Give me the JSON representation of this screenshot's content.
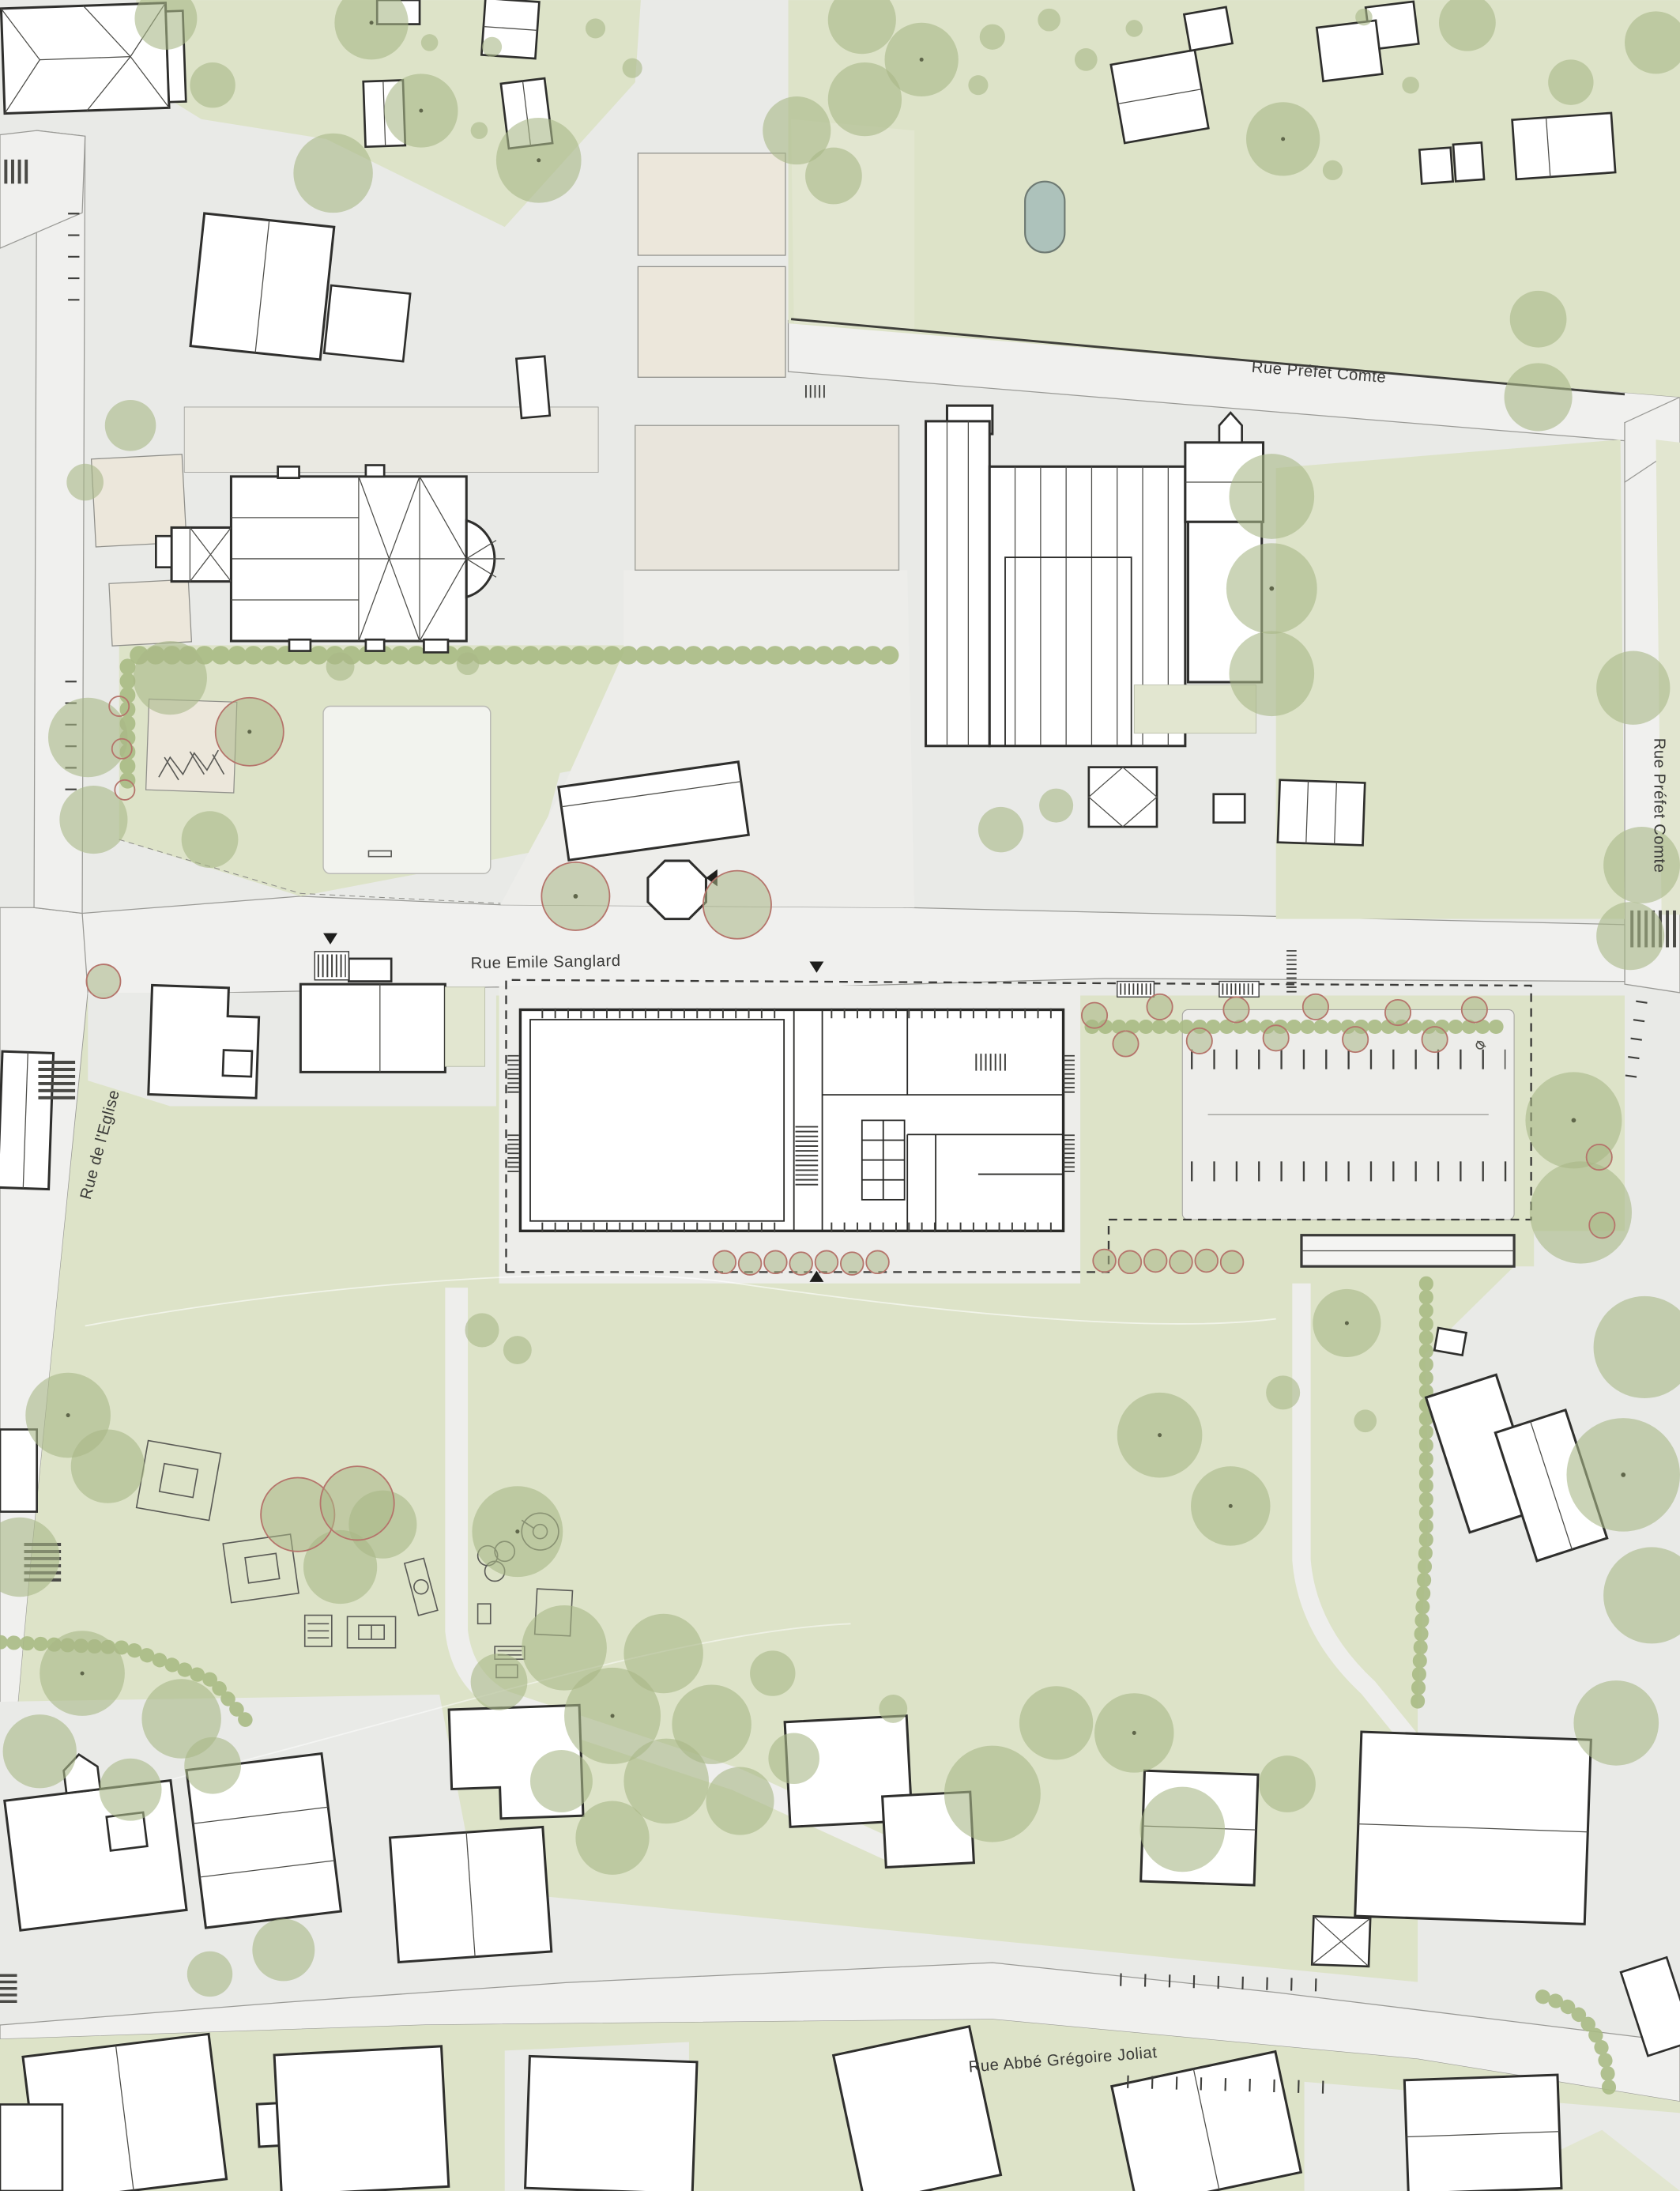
{
  "title": "Architectural site plan",
  "streets": {
    "prefet_comte_top": "Rue Préfet Comte",
    "prefet_comte_right": "Rue Préfet Comte",
    "emile_sanglard": "Rue Emile Sanglard",
    "eglise": "Rue de l'Eglise",
    "abbe_gregoire_joliat": "Rue Abbé Grégoire Joliat"
  },
  "colors": {
    "background": "#e9eae7",
    "road": "#f0f0ee",
    "green_space": "#dde3c8",
    "tree_canopy": "#a9b787",
    "new_tree_ring": "#b5746b",
    "building_fill": "#ffffff",
    "building_stroke": "#2f2f2d",
    "gravel_court": "#e9e5dc",
    "pond": "#adc2bb",
    "label_text": "#3a3a38"
  },
  "features": {
    "church": "church with cross-shaped hip roof",
    "new_building": "proposed building floor plan inside dashed site boundary",
    "parking": "parking lot with stall ticks",
    "playground": "playground equipment",
    "pond": "small pond"
  }
}
